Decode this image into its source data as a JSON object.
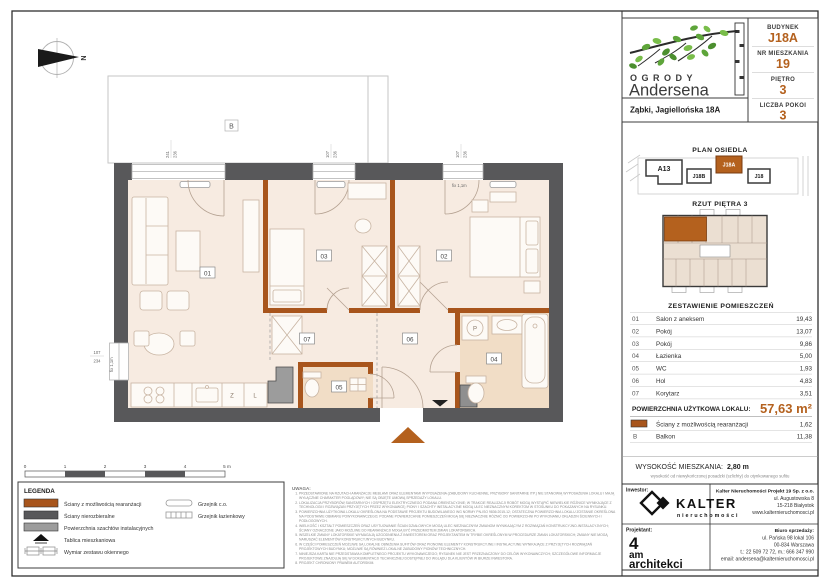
{
  "accent": "#b4611e",
  "wall_color": "#58585a",
  "header": {
    "brand_line1": "OGRODY",
    "brand_line2": "Andersena",
    "address": "Ząbki, Jagiellońska 18A",
    "fields": [
      {
        "label": "BUDYNEK",
        "value": "J18A"
      },
      {
        "label": "NR MIESZKANIA",
        "value": "19"
      },
      {
        "label": "PIĘTRO",
        "value": "3"
      },
      {
        "label": "LICZBA POKOI",
        "value": "3"
      }
    ]
  },
  "site_plan": {
    "title": "PLAN OSIEDLA",
    "buildings": [
      {
        "label": "A13"
      },
      {
        "label": "J18B"
      },
      {
        "label": "J18A"
      },
      {
        "label": "J18"
      }
    ],
    "highlighted": "J18A"
  },
  "floor_view": {
    "title": "RZUT PIĘTRA 3"
  },
  "rooms_table": {
    "title": "ZESTAWIENIE POMIESZCZEŃ",
    "rows": [
      {
        "no": "01",
        "name": "Salon z aneksem",
        "area": "19,43"
      },
      {
        "no": "02",
        "name": "Pokój",
        "area": "13,07"
      },
      {
        "no": "03",
        "name": "Pokój",
        "area": "9,86"
      },
      {
        "no": "04",
        "name": "Łazienka",
        "area": "5,00"
      },
      {
        "no": "05",
        "name": "WC",
        "area": "1,93"
      },
      {
        "no": "06",
        "name": "Hol",
        "area": "4,83"
      },
      {
        "no": "07",
        "name": "Korytarz",
        "area": "3,51"
      }
    ],
    "total_label": "POWIERZCHNIA UŻYTKOWA LOKALU:",
    "total_value": "57,63 m²",
    "rearr_row": {
      "name": "Ściany z możliwością rearanżacji",
      "area": "1,62"
    },
    "balcony_row": {
      "no": "B",
      "name": "Balkon",
      "area": "11,38"
    }
  },
  "height_info": {
    "label": "WYSOKOŚĆ MIESZKANIA:",
    "value": "2,80 m",
    "note": "wysokość od niewykończonej posadzki (szlichty) do otynkowanego sufitu"
  },
  "contact": {
    "investor_label": "Inwestor:",
    "investor_name": "KALTER",
    "investor_sub": "nieruchomości",
    "company": "Kalter Nieruchomości Projekt 19 Sp. z o.o.",
    "company_lines": [
      "ul. Augustowska 8",
      "15-218 Białystok",
      "www.kalternieruchomosci.pl"
    ],
    "designer_label": "Projektant:",
    "designer_line1": "4",
    "designer_line2": "am",
    "designer_line3": "architekci",
    "sales_label": "Biuro sprzedaży:",
    "sales_lines": [
      "ul. Pańska 98 lokal 106",
      "00-834 Warszawa",
      "t.: 22 509 72 72, m.: 666 347 990",
      "email: andersena@kalternieruchomosci.pl"
    ]
  },
  "legend": {
    "title": "LEGENDA",
    "items_left": [
      "Ściany z możliwością rearanżacji",
      "Ściany nierozbieralne",
      "Powierzchnia szachtów instalacyjnych",
      "Tablica mieszkaniowa",
      "Wymiar zestawu okiennego"
    ],
    "items_right": [
      "Grzejnik c.o.",
      "Grzejnik łazienkowy"
    ],
    "scale": [
      "0",
      "1",
      "2",
      "3",
      "4",
      "5 m"
    ]
  },
  "notes": {
    "title": "UWAGA:",
    "items": [
      "PRZEDSTAWIONE NA RZUTACH ARANŻACJE MEBLAMI ORAZ ELEMENTAMI WYPOSAŻENIA (ZABUDOWY KUCHENNE, PRZYBORY SANITARNE ITP.) NIE STANOWIĄ WYPOSAŻENIA LOKALU I MAJĄ WYŁĄCZNIE CHARAKTER POGLĄDOWY; NIE SĄ OBJĘTE UMOWĄ SPRZEDAŻY LOKALU.",
      "LOKALIZACJA PRZYBORÓW SANITARNYCH I OSPRZĘTU ELEKTRYCZNEGO PODANA ORIENTACYJNIE; W TRAKCIE REALIZACJI ROBÓT MOGĄ WYSTĄPIĆ NIEWIELKIE RÓŻNICE WYNIKAJĄCE Z TECHNOLOGII I ROZWIĄZAŃ PRZYJĘTYCH PRZEZ WYKONAWCĘ; PIONY I SZACHTY INSTALACYJNE MOGĄ ULEC NIEZNACZNYM KOREKTOM W STOSUNKU DO POKAZANYCH NA RYSUNKU.",
      "POWIERZCHNIA UŻYTKOWA LOKALU OKREŚLONA NA PODSTAWIE PROJEKTU BUDOWLANEGO WG NORMY PN-ISO 9836:2015-12; OSTATECZNA POWIERZCHNIA LOKALU ZOSTANIE OKREŚLONA NA PODSTAWIE OBMIARU POWYKONAWCZEGO; PODANE POWIERZCHNIE POMIESZCZEŃ MOGĄ SIĘ NIEZNACZNIE RÓŻNIĆ OD POWIERZCHNI PO WYKONANIU OKŁADZIN ŚCIENNYCH I PODŁOGOWYCH.",
      "WIELKOŚĆ I KSZTAŁT POMIESZCZEŃ ORAZ USYTUOWANIE ŚCIAN DZIAŁOWYCH MOGĄ ULEC NIEZNACZNYM ZMIANOM WYNIKAJĄCYM Z ROZWIĄZAŃ KONSTRUKCYJNO-INSTALACYJNYCH; ŚCIANY OZNACZONE JAKO MOŻLIWE DO REARANŻACJI MOGĄ BYĆ PRZEDMIOTEM ZMIAN LOKATORSKICH.",
      "WSZELKIE ZMIANY LOKATORSKIE WYMAGAJĄ UZGODNIENIA Z INWESTOREM ORAZ PROJEKTANTEM W TRYBIE OKREŚLONYM W PROCEDURZE ZMIAN LOKATORSKICH; ZMIANY NIE MOGĄ NARUSZAĆ ELEMENTÓW KONSTRUKCYJNYCH BUDYNKU.",
      "W CZĘŚCI POMIESZCZEŃ MOŻLIWE SĄ LOKALNE OBNIŻENIA SUFITÓW ORAZ PIONOWE ELEMENTY KONSTRUKCYJNE I INSTALACYJNE WYNIKAJĄCE Z PRZYJĘTYCH ROZWIĄZAŃ PROJEKTOWYCH BUDYNKU; MOŻLIWE SĄ RÓWNIEŻ LOKALNE ZABUDOWY PIONÓW TECHNICZNYCH.",
      "NINIEJSZA KARTA NIE PRZEDSTAWIA KOMPLETNEGO PROJEKTU WYKONAWCZEGO; RYSUNEK NIE JEST PRZEZNACZONY DO CELÓW WYKONAWCZYCH; SZCZEGÓŁOWE INFORMACJE PROJEKTOWE ZNAJDUJĄ SIĘ W DOKUMENTACJI TECHNICZNEJ DOSTĘPNEJ DO WGLĄDU DLA KLIENTÓW W BIURZE INWESTORA.",
      "PROJEKT CHRONIONY PRAWEM AUTORSKIM."
    ]
  },
  "plan": {
    "room_labels": [
      "01",
      "02",
      "03",
      "04",
      "05",
      "06",
      "07"
    ],
    "balcony_label": "B",
    "compass_label": "N",
    "kitchen": {
      "dishwasher": "Z",
      "fridge": "L"
    },
    "washer": "P",
    "dims": {
      "a_w": "241",
      "a_h": "236",
      "b_w": "107",
      "b_h": "236",
      "c_w": "107",
      "c_h": "236",
      "left_w": "107",
      "left_h": "234",
      "fix_left": "fix 1,1m",
      "fix_right": "fix 1,1m"
    }
  }
}
